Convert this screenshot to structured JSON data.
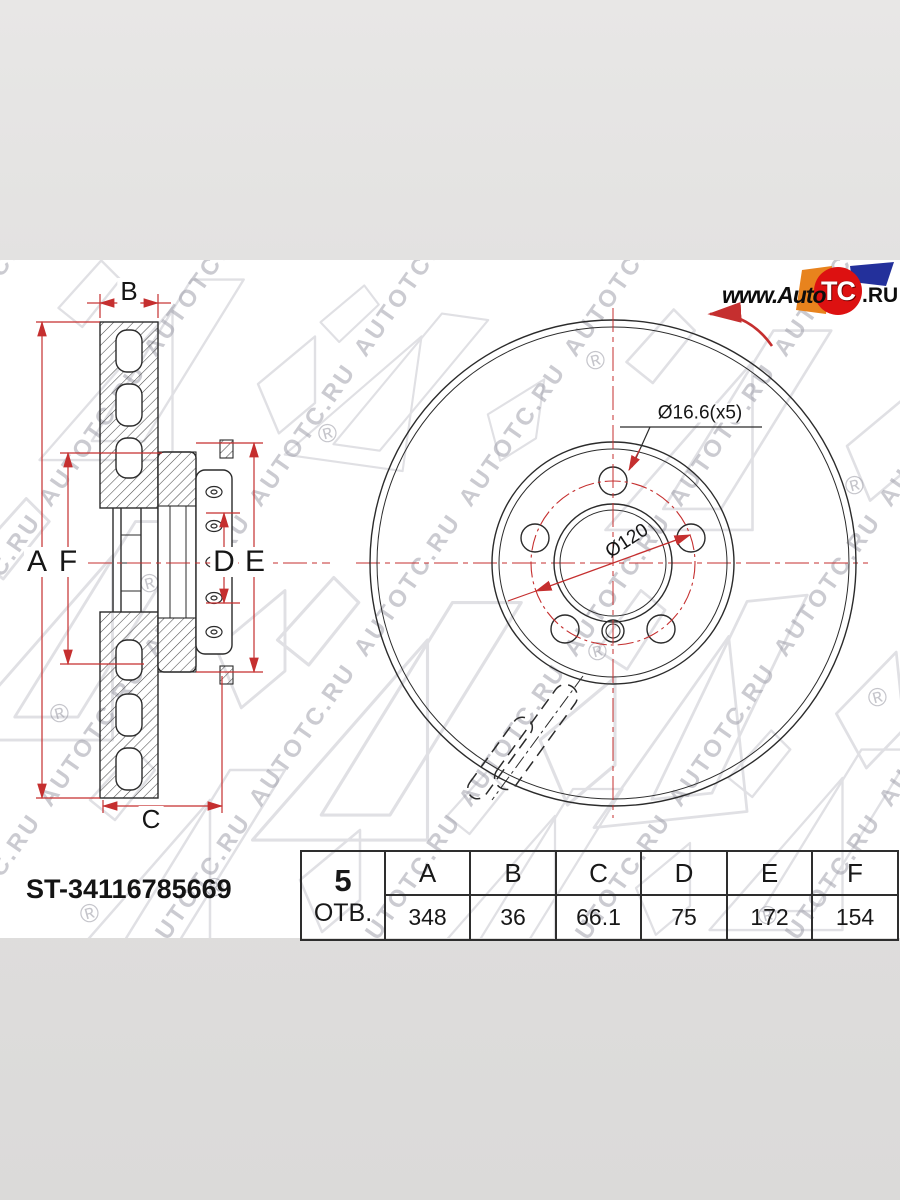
{
  "logo": {
    "prefix": "www.Auto",
    "circle": "TC",
    "suffix": ".RU"
  },
  "part_number": "ST-34116785669",
  "table": {
    "holes_count": "5",
    "holes_label": "ОТВ.",
    "columns": [
      "A",
      "B",
      "C",
      "D",
      "E",
      "F"
    ],
    "values": [
      "348",
      "36",
      "66.1",
      "75",
      "172",
      "154"
    ]
  },
  "annotations": {
    "bolt_hole_diameter": "Ø16.6(x5)",
    "bolt_circle_diameter": "Ø120",
    "dim_a": "A",
    "dim_b": "B",
    "dim_c": "C",
    "dim_d": "D",
    "dim_e": "E",
    "dim_f": "F"
  },
  "watermark": {
    "text": "AUTOTC.RU",
    "registered": "®"
  },
  "colors": {
    "dimension_red": "#c52f2f",
    "drawing_line": "#2b2b2b",
    "logo_red": "#dd1111",
    "logo_orange": "#e8831d",
    "logo_blue": "#23309b",
    "watermark_gray": "#b9b9c2"
  }
}
